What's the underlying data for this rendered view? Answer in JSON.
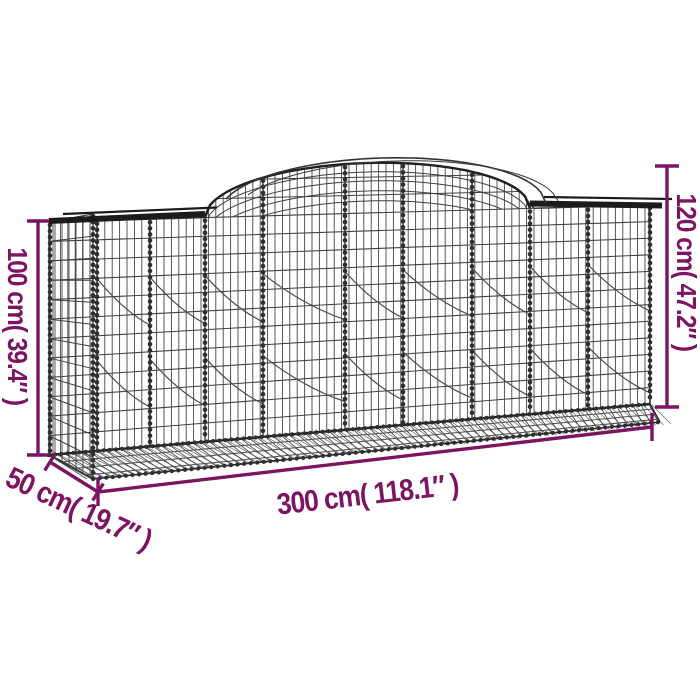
{
  "figure": {
    "background_color": "#ffffff",
    "accent_color": "#7C1462",
    "wire_color": "#3a3a3a",
    "rim_color": "#1b1b1b"
  },
  "dimensions": {
    "height_left": {
      "label": "100 cm( 39.4″ )",
      "value_cm": "100",
      "value_inch": "39.4"
    },
    "height_right": {
      "label": "120 cm( 47.2″ )",
      "value_cm": "120",
      "value_inch": "47.2"
    },
    "length": {
      "label": "300 cm( 118.1″ )",
      "value_cm": "300",
      "value_inch": "118.1"
    },
    "depth": {
      "label": "50 cm( 19.7″ )",
      "value_cm": "50",
      "value_inch": "19.7"
    }
  }
}
